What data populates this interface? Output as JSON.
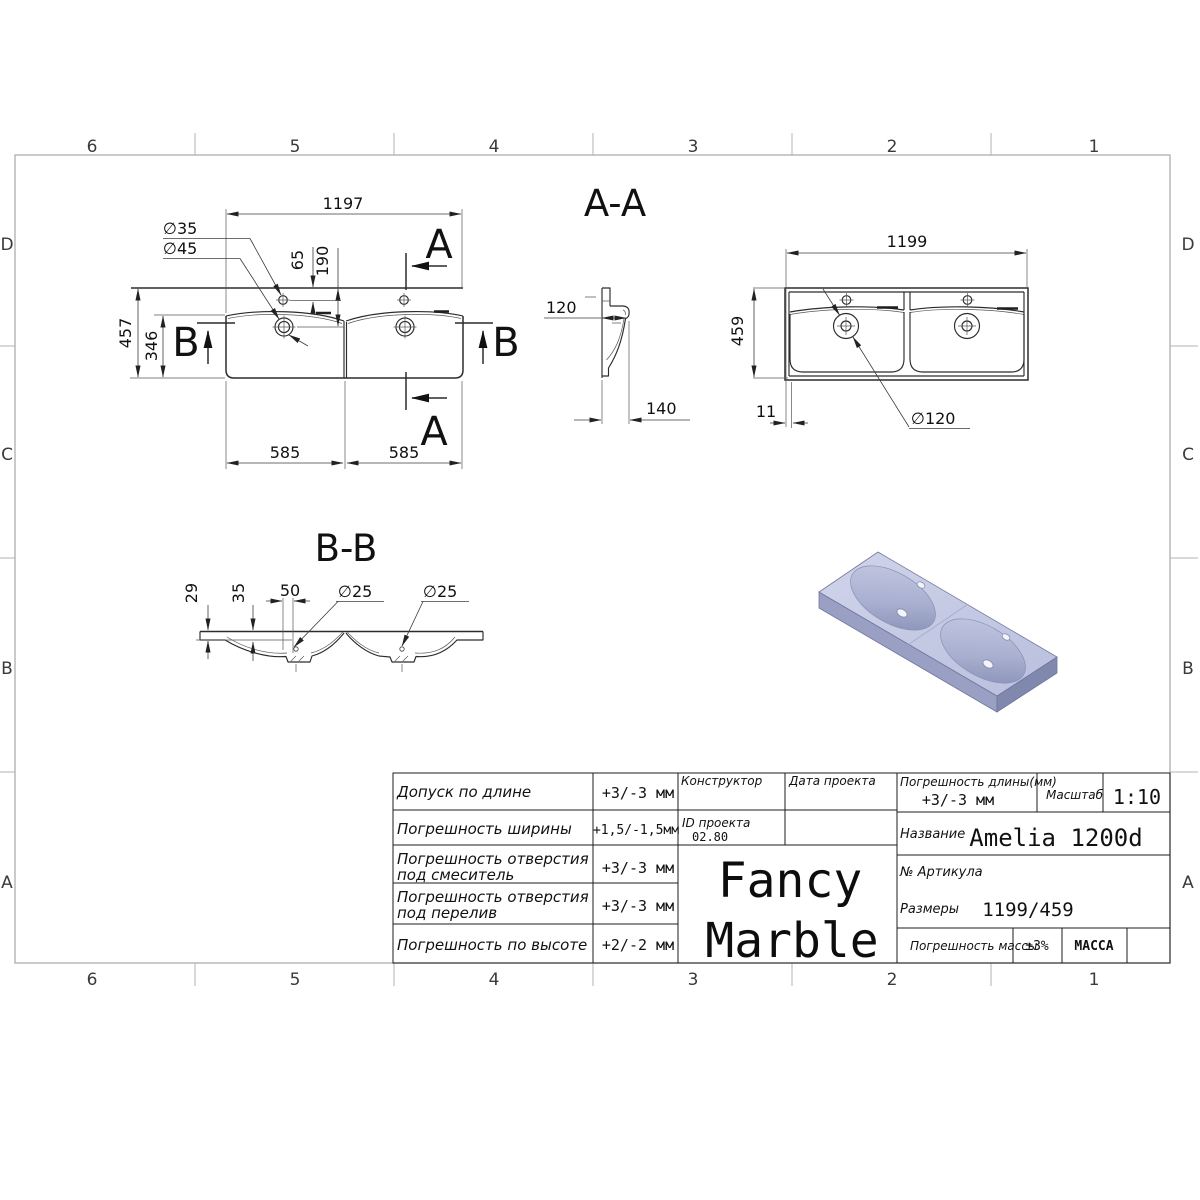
{
  "sheet": {
    "grid": {
      "top": [
        "6",
        "5",
        "4",
        "3",
        "2",
        "1"
      ],
      "bottom": [
        "6",
        "5",
        "4",
        "3",
        "2",
        "1"
      ],
      "left": [
        "D",
        "C",
        "B",
        "A"
      ],
      "right": [
        "D",
        "C",
        "B",
        "A"
      ]
    }
  },
  "plan_view": {
    "width": "1197",
    "height": "457",
    "basin_depth": "346",
    "faucet_offset": "65",
    "drain_offset": "190",
    "faucet_dia": "∅35",
    "drain_dia": "∅45",
    "basin_left_width": "585",
    "basin_right_width": "585",
    "section_a": "A",
    "section_b": "B"
  },
  "section_aa": {
    "title": "A-A",
    "height": "120",
    "depth": "140"
  },
  "top_view": {
    "width": "1199",
    "depth": "459",
    "rim": "11",
    "drain_dia": "∅120"
  },
  "section_bb": {
    "title": "B-B",
    "edge_thickness": "29",
    "mid_thickness": "35",
    "boss_width": "50",
    "drain_hole_left": "∅25",
    "drain_hole_right": "∅25"
  },
  "title_block": {
    "tolerances": [
      {
        "line1": "Допуск по длине",
        "line2": "",
        "value": "+3/-3 мм"
      },
      {
        "line1": "Погрешность ширины",
        "line2": "",
        "value": "+1,5/-1,5мм"
      },
      {
        "line1": "Погрешность отверстия",
        "line2": "под смеситель",
        "value": "+3/-3 мм"
      },
      {
        "line1": "Погрешность отверстия",
        "line2": "под перелив",
        "value": "+3/-3 мм"
      },
      {
        "line1": "Погрешность по высоте",
        "line2": "",
        "value": "+2/-2 мм"
      }
    ],
    "designer_label": "Конструктор",
    "project_date_label": "Дата проекта",
    "project_id_label": "ID проекта",
    "project_id_value": "02.80",
    "brand_line1": "Fancy",
    "brand_line2": "Marble",
    "length_tolerance_label": "Погрешность длины(мм)",
    "length_tolerance_value": "+3/-3 мм",
    "scale_label": "Масштаб",
    "scale_value": "1:10",
    "name_label": "Название",
    "name_value": "Amelia 1200d",
    "article_label": "№ Артикула",
    "size_label": "Размеры",
    "size_value": "1199/459",
    "mass_tolerance_label": "Погрешность массы",
    "mass_tolerance_value": "±3%",
    "mass_label": "МАССА"
  }
}
